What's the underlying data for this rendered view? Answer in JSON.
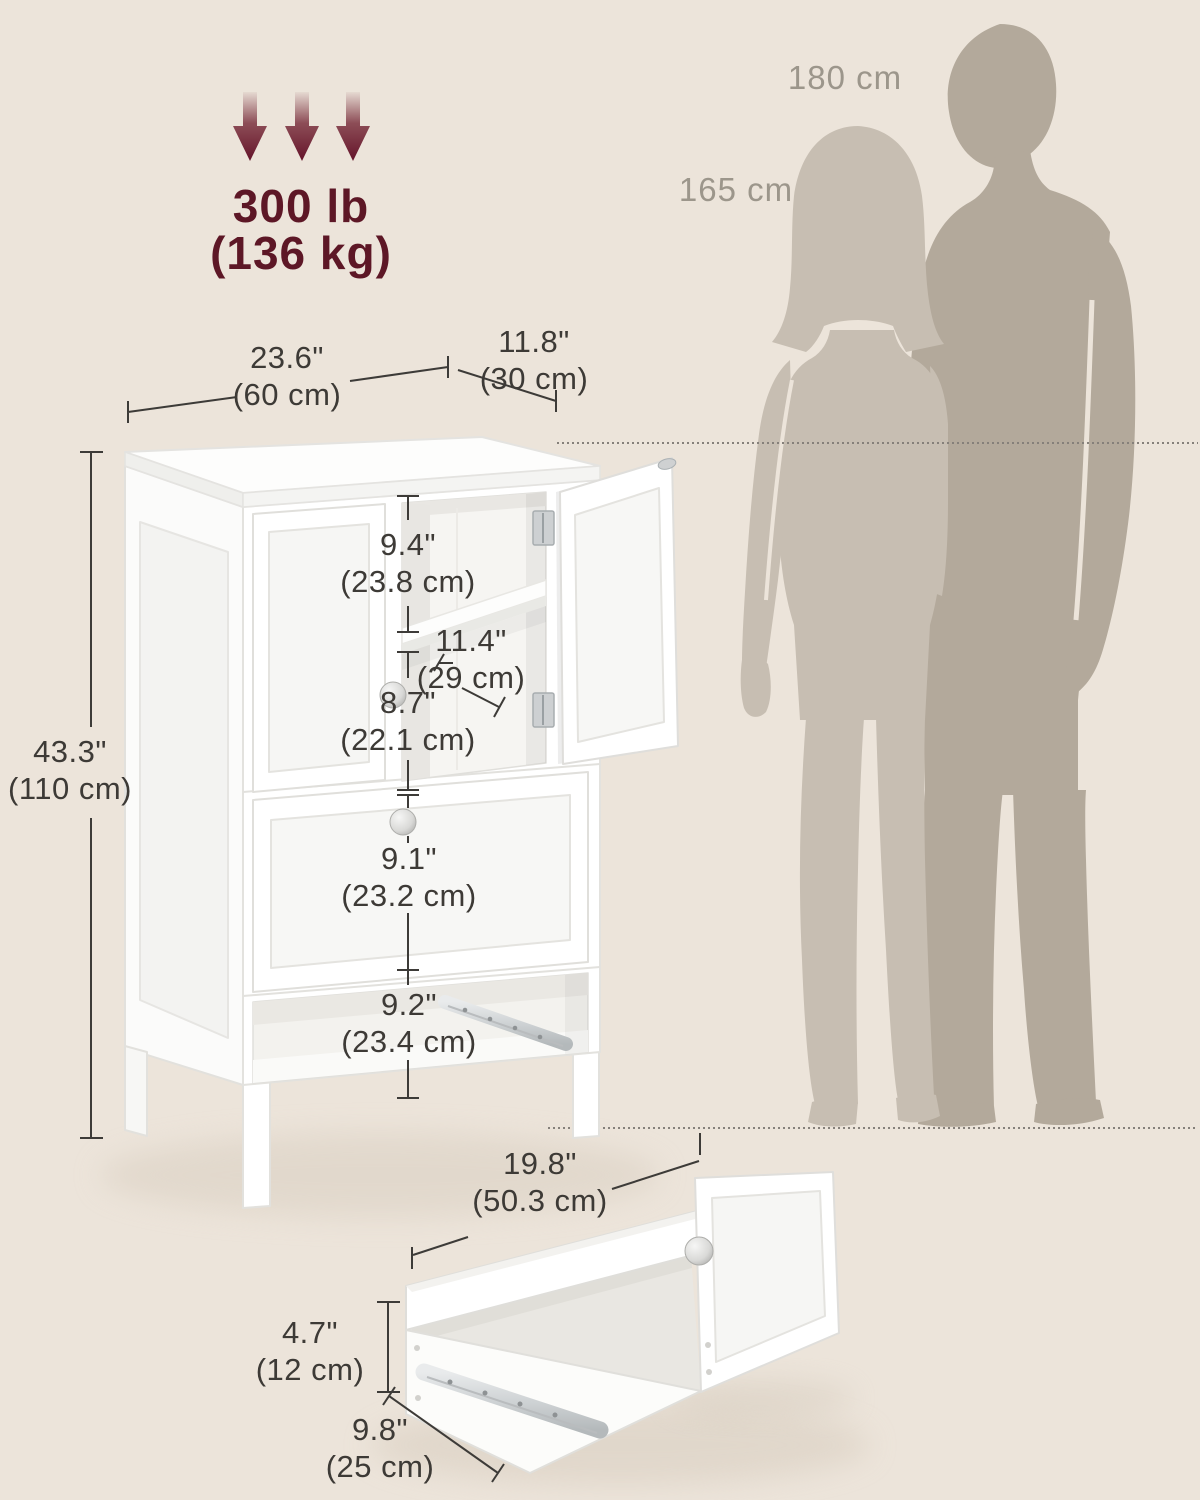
{
  "title": "Storage cabinet dimension diagram",
  "weight_capacity": {
    "lb": "300 lb",
    "kg": "(136 kg)"
  },
  "persons": {
    "man_height": "180 cm",
    "woman_height": "165 cm"
  },
  "dims": {
    "width": {
      "inch": "23.6\"",
      "cm": "(60 cm)"
    },
    "depth": {
      "inch": "11.8\"",
      "cm": "(30 cm)"
    },
    "height": {
      "inch": "43.3\"",
      "cm": "(110 cm)"
    },
    "upper_shelf": {
      "inch": "9.4\"",
      "cm": "(23.8 cm)"
    },
    "inner_depth": {
      "inch": "11.4\"",
      "cm": "(29 cm)"
    },
    "lower_shelf": {
      "inch": "8.7\"",
      "cm": "(22.1 cm)"
    },
    "drawer_section": {
      "inch": "9.1\"",
      "cm": "(23.2 cm)"
    },
    "open_compartment": {
      "inch": "9.2\"",
      "cm": "(23.4 cm)"
    },
    "drawer_width": {
      "inch": "19.8\"",
      "cm": "(50.3 cm)"
    },
    "drawer_height": {
      "inch": "4.7\"",
      "cm": "(12 cm)"
    },
    "drawer_depth": {
      "inch": "9.8\"",
      "cm": "(25 cm)"
    }
  },
  "colors": {
    "background": "#ece4da",
    "accent_maroon": "#5d1726",
    "dimension_text": "#3d3a36",
    "person_label": "#9c968b",
    "silhouette_man": "#b3a99b",
    "silhouette_woman": "#c7beb2",
    "cabinet_white": "#ffffff"
  }
}
